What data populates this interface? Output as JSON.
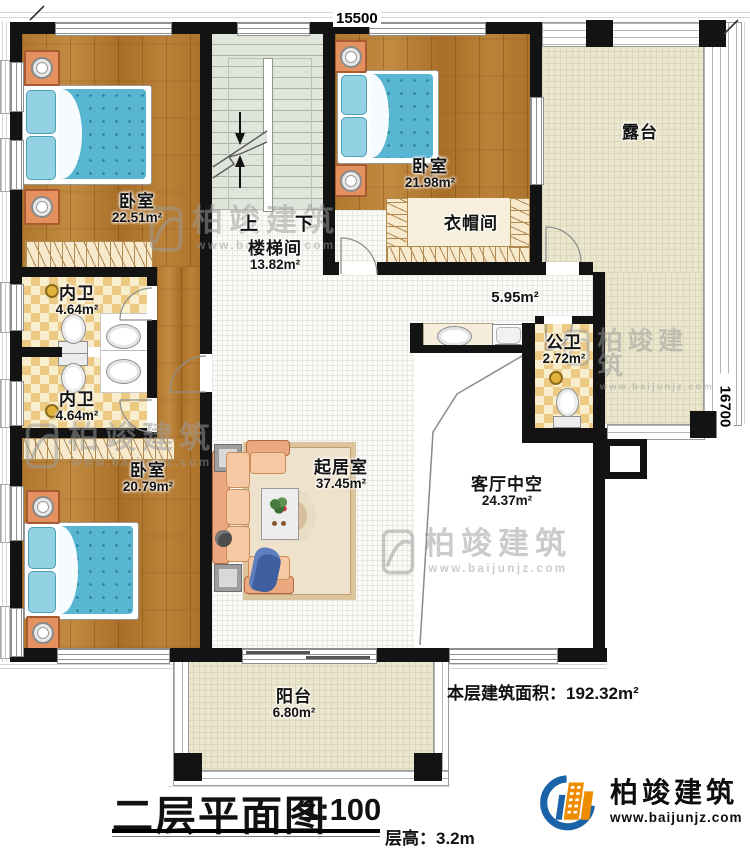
{
  "dimensions": {
    "top": "15500",
    "right": "16700"
  },
  "stairs": {
    "up": "上",
    "down": "下"
  },
  "rooms": {
    "bedroom1": {
      "name": "卧室",
      "area": "22.51m²"
    },
    "bedroom2": {
      "name": "卧室",
      "area": "21.98m²"
    },
    "bedroom3": {
      "name": "卧室",
      "area": "20.79m²"
    },
    "stairwell": {
      "name": "楼梯间",
      "area": "13.82m²"
    },
    "cloakroom": {
      "name": "衣帽间"
    },
    "terrace": {
      "name": "露台"
    },
    "bath1": {
      "name": "内卫",
      "area": "4.64m²"
    },
    "bath2": {
      "name": "内卫",
      "area": "4.64m²"
    },
    "public_bath": {
      "name": "公卫",
      "area": "2.72m²"
    },
    "hall": {
      "area": "5.95m²"
    },
    "living_room": {
      "name": "起居室",
      "area": "37.45m²"
    },
    "living_void": {
      "name": "客厅中空",
      "area": "24.37m²"
    },
    "balcony": {
      "name": "阳台",
      "area": "6.80m²"
    }
  },
  "annotations": {
    "floor_area_label": "本层建筑面积：",
    "floor_area_value": "192.32m²"
  },
  "title_block": {
    "title": "二层平面图",
    "scale": "1:100",
    "floor_height": "层高：3.2m"
  },
  "brand": {
    "name": "柏竣建筑",
    "url": "www.baijunjz.com"
  },
  "watermark": {
    "name": "柏竣建筑",
    "url": "www.baijunjz.com"
  }
}
